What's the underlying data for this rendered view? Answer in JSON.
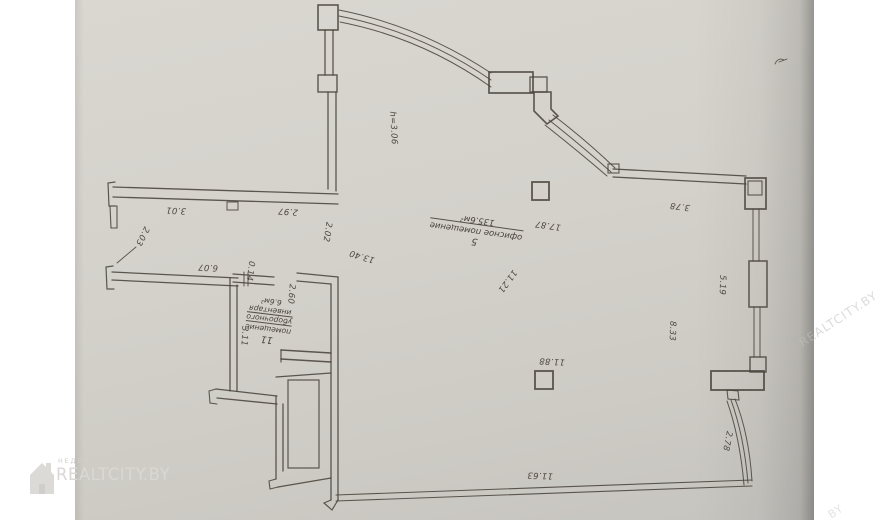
{
  "document": {
    "kind": "scanned floor plan page"
  },
  "colors": {
    "paper": "#d4d1cb",
    "ink": "#49443c",
    "label_text": "#4d483f",
    "watermark": "#d9d8d4",
    "page_background": "#ffffff"
  },
  "watermark": {
    "agency_label": "НЕДВИЖИМОСТЬ",
    "brand": "REALTCITY.BY",
    "side_fragment": "REALTCITY.BY",
    "corner_fragment": "BY"
  },
  "plan": {
    "rooms": [
      {
        "number": "5",
        "name": "офисное помещение",
        "area": "135.6м²",
        "height_note": "h=3.06"
      },
      {
        "number": "11",
        "name_lines": [
          "помещение",
          "уборочного",
          "инвентаря"
        ],
        "area": "6.6м²"
      }
    ],
    "dimension_labels": [
      {
        "text": "3.01",
        "x": 176,
        "y": 210,
        "rot": 183
      },
      {
        "text": "2.97",
        "x": 288,
        "y": 211,
        "rot": 184
      },
      {
        "text": "2.03",
        "x": 142,
        "y": 236,
        "rot": 117
      },
      {
        "text": "2.02",
        "x": 327,
        "y": 232,
        "rot": 99
      },
      {
        "text": "13.40",
        "x": 362,
        "y": 256,
        "rot": 197
      },
      {
        "text": "6.07",
        "x": 208,
        "y": 267,
        "rot": 183
      },
      {
        "text": "0.14",
        "x": 250,
        "y": 271,
        "rot": 97
      },
      {
        "text": "2.60",
        "x": 291,
        "y": 294,
        "rot": 95
      },
      {
        "text": "3.11",
        "x": 244,
        "y": 336,
        "rot": 93
      },
      {
        "text": "h=3.06",
        "x": 393,
        "y": 128,
        "rot": 87
      },
      {
        "text": "17.87",
        "x": 548,
        "y": 225,
        "rot": 188
      },
      {
        "text": "11.21",
        "x": 507,
        "y": 281,
        "rot": 126
      },
      {
        "text": "11.88",
        "x": 552,
        "y": 361,
        "rot": 183
      },
      {
        "text": "11.63",
        "x": 540,
        "y": 475,
        "rot": 182
      },
      {
        "text": "8.33",
        "x": 672,
        "y": 331,
        "rot": 92
      },
      {
        "text": "5.19",
        "x": 722,
        "y": 285,
        "rot": 92
      },
      {
        "text": "3.78",
        "x": 680,
        "y": 206,
        "rot": 187
      },
      {
        "text": "2.78",
        "x": 727,
        "y": 441,
        "rot": 101
      }
    ]
  }
}
